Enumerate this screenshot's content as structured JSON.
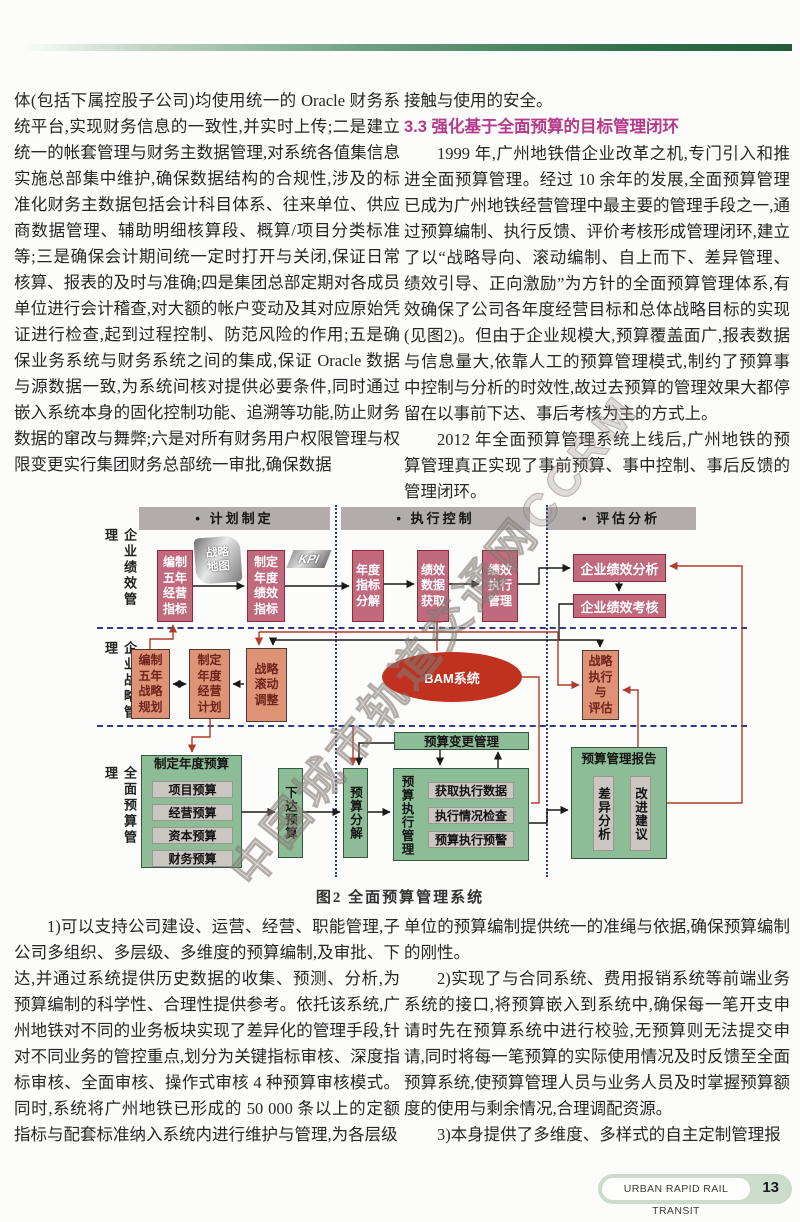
{
  "page": {
    "caption": "图2  全面预算管理系统",
    "watermark": "中国城市轨道交通网CCRM",
    "footer": {
      "journal": "URBAN RAPID RAIL TRANSIT",
      "page_number": "13"
    }
  },
  "left_column": {
    "paragraphs": [
      "体(包括下属控股子公司)均使用统一的 Oracle 财务系统平台,实现财务信息的一致性,并实时上传;二是建立统一的帐套管理与财务主数据管理,对系统各值集信息实施总部集中维护,确保数据结构的合规性,涉及的标准化财务主数据包括会计科目体系、往来单位、供应商数据管理、辅助明细核算段、概算/项目分类标准等;三是确保会计期间统一定时打开与关闭,保证日常核算、报表的及时与准确;四是集团总部定期对各成员单位进行会计稽查,对大额的帐户变动及其对应原始凭证进行检查,起到过程控制、防范风险的作用;五是确保业务系统与财务系统之间的集成,保证 Oracle 数据与源数据一致,为系统间核对提供必要条件,同时通过嵌入系统本身的固化控制功能、追溯等功能,防止财务数据的窜改与舞弊;六是对所有财务用户权限管理与权限变更实行集团财务总部统一审批,确保数据"
    ]
  },
  "right_column": {
    "intro": "接触与使用的安全。",
    "heading": "3.3  强化基于全面预算的目标管理闭环",
    "paragraphs": [
      "1999 年,广州地铁借企业改革之机,专门引入和推进全面预算管理。经过 10 余年的发展,全面预算管理已成为广州地铁经营管理中最主要的管理手段之一,通过预算编制、执行反馈、评价考核形成管理闭环,建立了以“战略导向、滚动编制、自上而下、差异管理、绩效引导、正向激励”为方针的全面预算管理体系,有效确保了公司各年度经营目标和总体战略目标的实现(见图2)。但由于企业规模大,预算覆盖面广,报表数据与信息量大,依靠人工的预算管理模式,制约了预算事中控制与分析的时效性,故过去预算的管理效果大都停留在以事前下达、事后考核为主的方式上。",
      "2012 年全面预算管理系统上线后,广州地铁的预算管理真正实现了事前预算、事中控制、事后反馈的管理闭环。"
    ]
  },
  "bottom_left": {
    "paragraphs": [
      "1)可以支持公司建设、运营、经营、职能管理,子公司多组织、多层级、多维度的预算编制,及审批、下达,并通过系统提供历史数据的收集、预测、分析,为预算编制的科学性、合理性提供参考。依托该系统,广州地铁对不同的业务板块实现了差异化的管理手段,针对不同业务的管控重点,划分为关键指标审核、深度指标审核、全面审核、操作式审核 4 种预算审核模式。同时,系统将广州地铁已形成的 50 000 条以上的定额指标与配套标准纳入系统内进行维护与管理,为各层级"
    ]
  },
  "bottom_right": {
    "paragraphs": [
      "单位的预算编制提供统一的准绳与依据,确保预算编制的刚性。",
      "2)实现了与合同系统、费用报销系统等前端业务系统的接口,将预算嵌入到系统中,确保每一笔开支申请时先在预算系统中进行校验,无预算则无法提交申请,同时将每一笔预算的实际使用情况及时反馈至全面预算系统,使预算管理人员与业务人员及时掌握预算额度的使用与剩余情况,合理调配资源。",
      "3)本身提供了多维度、多样式的自主定制管理报"
    ]
  },
  "diagram": {
    "section_headers": {
      "plan": "•  计划制定",
      "exec": "•  执行控制",
      "eval": "•  评估分析"
    },
    "row_labels": {
      "perf": "企业绩效管理",
      "strategy": "企业战略管理",
      "budget": "全面预算管理"
    },
    "nodes": {
      "five_year_ops": "编制\n五年\n经营\n指标",
      "strategy_map": "战略\n地图",
      "annual_kpi": "制定\n年度\n绩效\n指标",
      "kpi_tag": "KPI",
      "kpi_decompose": "年度\n指标\n分解",
      "perf_data": "绩效\n数据\n获取",
      "perf_exec": "绩效\n执行\n管理",
      "perf_analysis": "企业绩效分析",
      "perf_review": "企业绩效考核",
      "five_year_strategy": "编制\n五年\n战略\n规划",
      "annual_ops_plan": "制定\n年度\n经营\n计划",
      "strategy_rolling": "战略\n滚动\n调整",
      "bam": "BAM系统",
      "strategy_eval": "战略\n执行\n与\n评估",
      "annual_budget_title": "制定年度预算",
      "budget_items": [
        "项目预算",
        "经营预算",
        "资本预算",
        "财务预算"
      ],
      "issue_budget": "下达预算",
      "budget_decompose": "预算分解",
      "budget_change": "预算变更管理",
      "budget_exec_title": "预算执行管理",
      "budget_exec_items": [
        "获取执行数据",
        "执行情况检查",
        "预算执行预警"
      ],
      "budget_report_title": "预算管理报告",
      "variance_analysis": "差异分析",
      "improvement": "改进建议"
    }
  }
}
